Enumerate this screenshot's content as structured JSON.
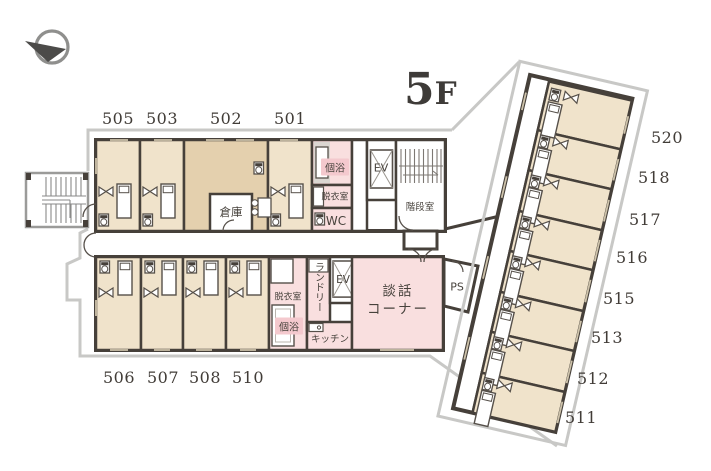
{
  "floor_indicator": {
    "number": "5",
    "suffix": "F"
  },
  "rooms": {
    "top_row": [
      "505",
      "503",
      "502",
      "501"
    ],
    "bottom_row": [
      "506",
      "507",
      "508",
      "510"
    ],
    "wing": [
      "520",
      "518",
      "517",
      "516",
      "515",
      "513",
      "512",
      "511"
    ]
  },
  "facilities": {
    "bath_top": "個浴",
    "changing_top": "脱衣室",
    "wc": "WC",
    "elevator_top": "EV",
    "stairwell": "階段室",
    "storage": "倉庫",
    "changing_bottom": "脱衣室",
    "bath_bottom": "個浴",
    "laundry": "ランドリー",
    "elevator_bottom": "EV",
    "kitchen": "キッチン",
    "lounge": "談話\nコーナー",
    "pipe_space": "PS"
  },
  "colors": {
    "wall": "#46403a",
    "room_tan": "#f0e3cb",
    "room_tan_dark": "#e4d0ae",
    "room_pink": "#f9dfdf",
    "label_chip_pink": "#f4c9ce",
    "boundary_gray": "#c8c8c6"
  },
  "icons": {
    "compass": "north-arrow"
  }
}
